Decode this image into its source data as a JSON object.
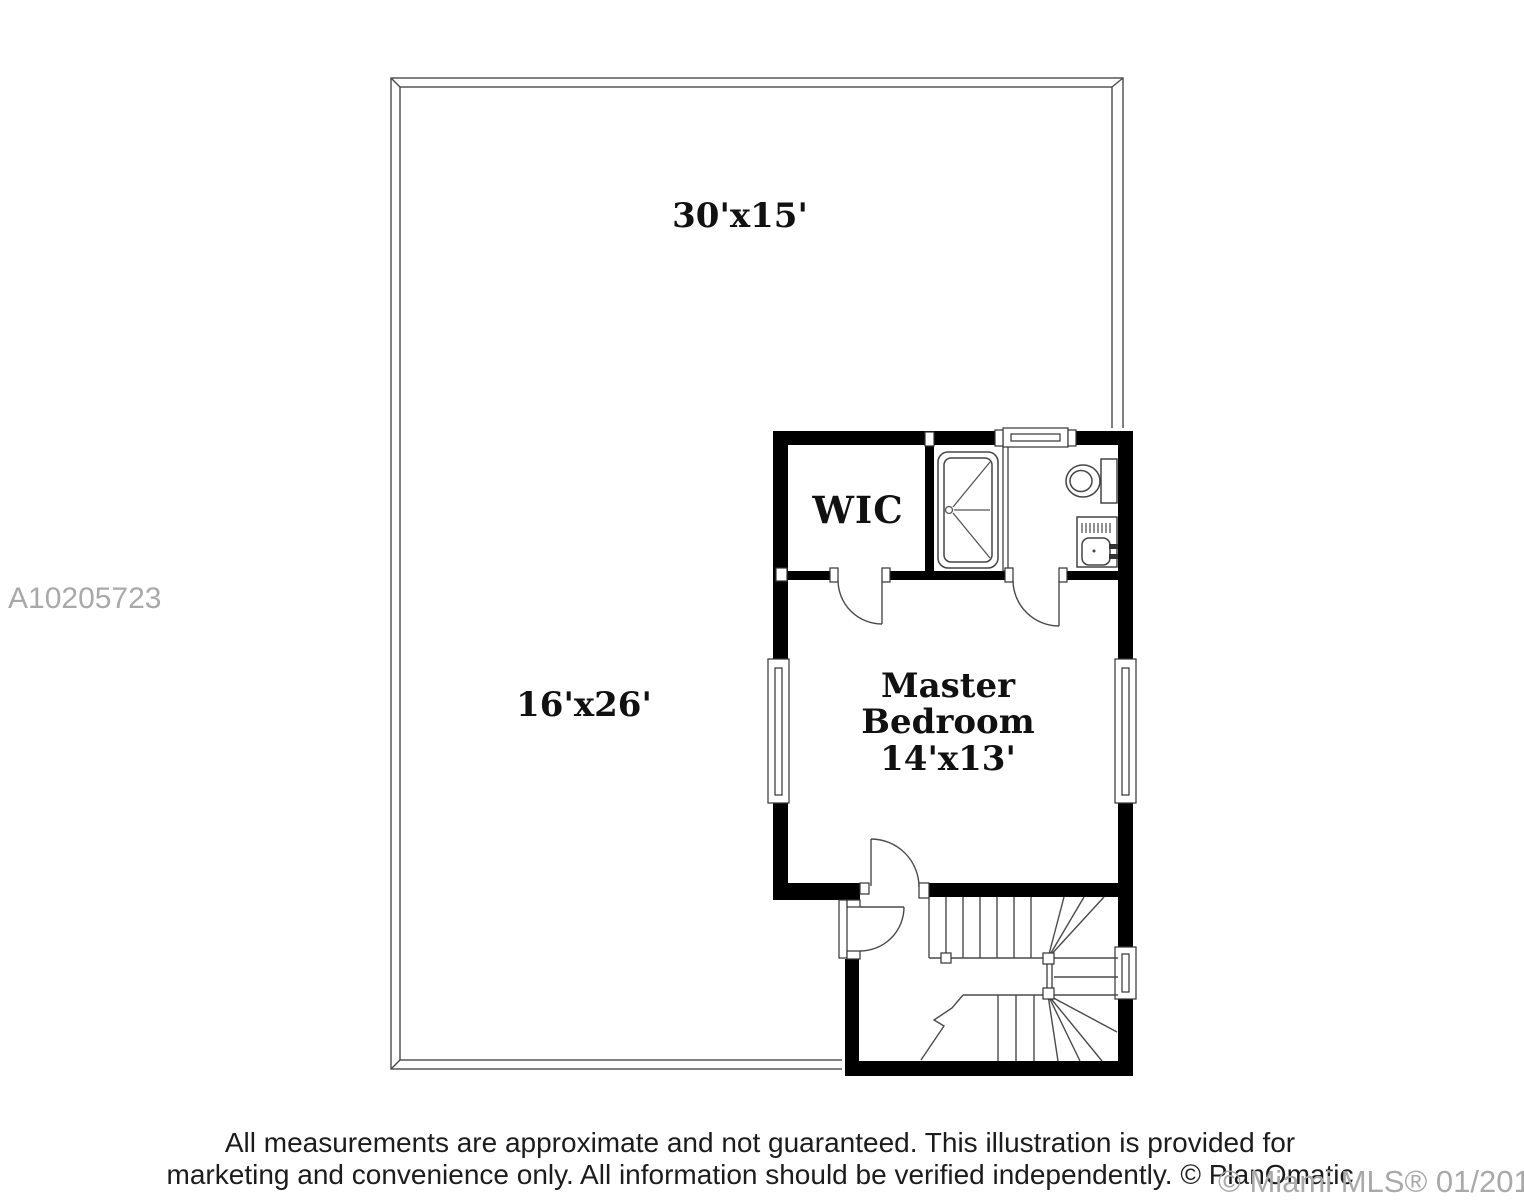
{
  "watermarks": {
    "listing_id": "A10205723",
    "mls_stamp": "© Miami MLS® 01/2017"
  },
  "footer": {
    "line1": "All measurements are approximate and not guaranteed. This illustration is provided for",
    "line2": "marketing and convenience only. All information should be verified independently. © PlanOmatic"
  },
  "floorplan": {
    "areas": {
      "terrace_upper": {
        "label": "30'x15'"
      },
      "terrace_lower": {
        "label": "16'x26'"
      },
      "wic": {
        "label": "WIC"
      },
      "master_bedroom": {
        "label_line1": "Master",
        "label_line2": "Bedroom",
        "dimensions": "14'x13'"
      }
    },
    "fixtures": [
      "shower",
      "toilet",
      "sink",
      "staircase",
      "windows",
      "doors"
    ],
    "colors": {
      "wall": "#000000",
      "thin_line": "#3f3f3f",
      "watermark_gray": "#a9a9a9",
      "label_text": "#111111"
    }
  }
}
